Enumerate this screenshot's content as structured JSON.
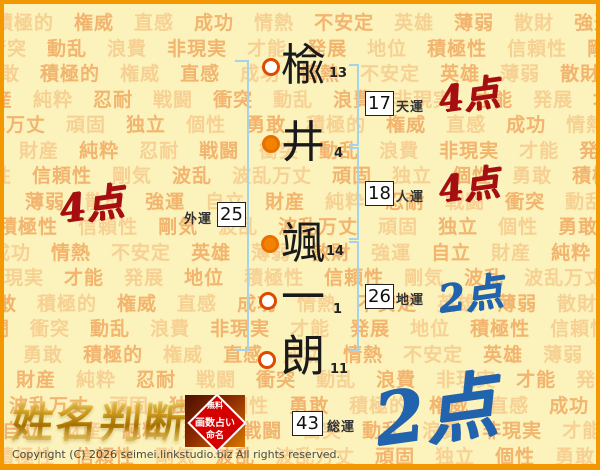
{
  "page": {
    "background": "#fbf3bb",
    "border_color": "#f39800"
  },
  "watermark": {
    "words": [
      "積極的",
      "地位",
      "財産",
      "権威",
      "積極性",
      "純粋",
      "直感",
      "信頼性",
      "忍耐",
      "成功",
      "剛気",
      "戦闘",
      "情熱",
      "波乱",
      "衝突",
      "不安定",
      "波乱万丈",
      "動乱",
      "英雄",
      "頑固",
      "浪費",
      "薄弱",
      "独立",
      "非現実",
      "散財",
      "個性",
      "才能",
      "強運",
      "勇敢",
      "発展",
      "自立"
    ]
  },
  "name": {
    "chars": [
      {
        "char": "楡",
        "strokes": "13",
        "marker": "open"
      },
      {
        "char": "井",
        "strokes": "4",
        "marker": "filled"
      },
      {
        "char": "颯",
        "strokes": "14",
        "marker": "filled"
      },
      {
        "char": "一",
        "strokes": "1",
        "marker": "open"
      },
      {
        "char": "朗",
        "strokes": "11",
        "marker": "open"
      }
    ]
  },
  "fortunes": {
    "tenun": {
      "label": "天運",
      "value": "17",
      "score": "4点"
    },
    "jinun": {
      "label": "人運",
      "value": "18",
      "score": "4点"
    },
    "chiun": {
      "label": "地運",
      "value": "26",
      "score": "2点"
    },
    "gaiun": {
      "label": "外運",
      "value": "25",
      "score": "4点"
    },
    "souun": {
      "label": "総運",
      "value": "43",
      "score": "2点"
    }
  },
  "logo": {
    "title": "姓名判断",
    "badge_line1": "無料",
    "badge_line2": "画数占い",
    "badge_line3": "命名"
  },
  "footer": {
    "copyright": "Copyright (C) 2026 seimei.linkstudio.biz All rights reserved."
  },
  "colors": {
    "score_red": "#a60f12",
    "score_blue": "#2263ae",
    "bracket_blue": "#a6d3ec",
    "marker_orange": "#f08300"
  }
}
